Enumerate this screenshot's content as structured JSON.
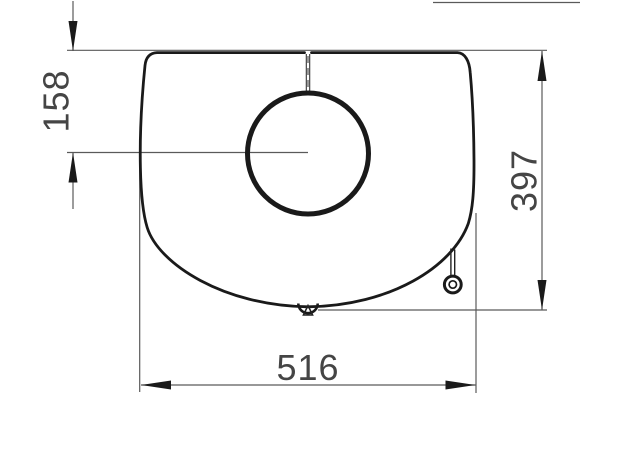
{
  "colors": {
    "bg": "#ffffff",
    "outline": "#1a1a1a",
    "dim": "#5a5a5a",
    "label": "#454545"
  },
  "dimensions": [
    {
      "id": "top-edge-to-flue-center",
      "label": "158",
      "orientation": "vertical",
      "side": "left"
    },
    {
      "id": "top-edge-to-bottom-edge",
      "label": "397",
      "orientation": "vertical",
      "side": "right"
    },
    {
      "id": "overall-width",
      "label": "516",
      "orientation": "horizontal",
      "side": "bottom"
    }
  ]
}
